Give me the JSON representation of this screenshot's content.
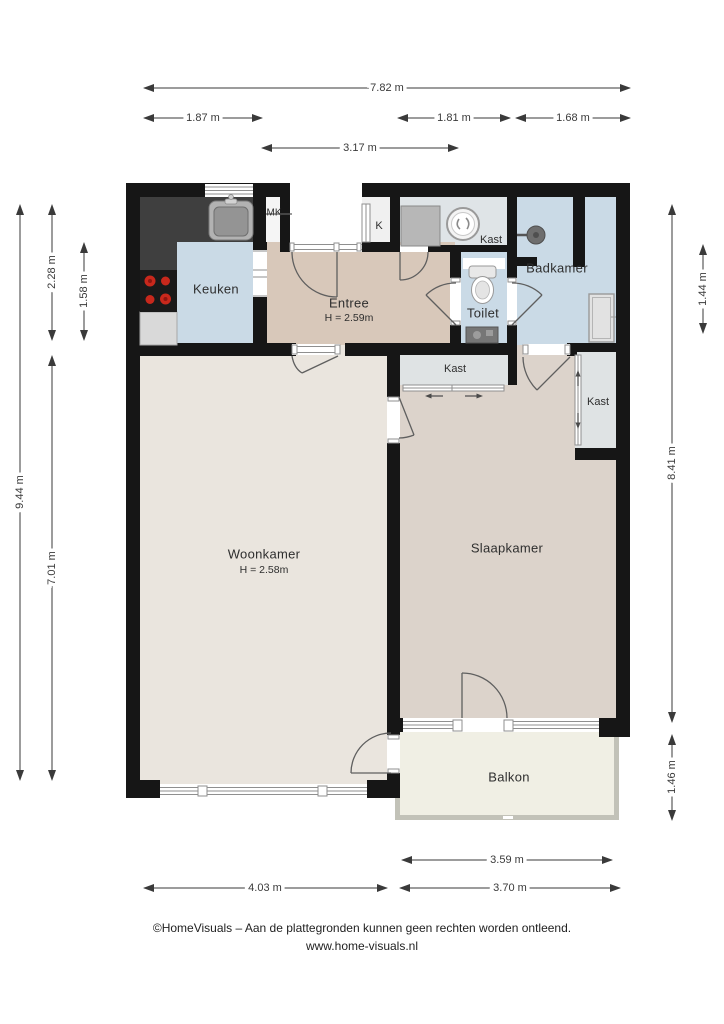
{
  "plan": {
    "rooms": {
      "keuken": {
        "label": "Keuken"
      },
      "entree": {
        "label": "Entree",
        "height_label": "H = 2.59m"
      },
      "mk": {
        "label": "MK"
      },
      "k": {
        "label": "K"
      },
      "kast_top": {
        "label": "Kast"
      },
      "toilet": {
        "label": "Toilet"
      },
      "badkamer": {
        "label": "Badkamer"
      },
      "kast_mid": {
        "label": "Kast"
      },
      "kast_right": {
        "label": "Kast"
      },
      "woonkamer": {
        "label": "Woonkamer",
        "height_label": "H = 2.58m"
      },
      "slaapkamer": {
        "label": "Slaapkamer"
      },
      "balkon": {
        "label": "Balkon"
      }
    },
    "dimensions": {
      "top_total": "7.82 m",
      "top_left": "1.87 m",
      "top_mid": "1.81 m",
      "top_right": "1.68 m",
      "top_entree": "3.17 m",
      "left_total": "9.44 m",
      "left_upper": "2.28 m",
      "left_kitchen": "1.58 m",
      "left_lower": "7.01 m",
      "right_upper": "1.44 m",
      "right_total": "8.41 m",
      "right_lower": "1.46 m",
      "bottom_balcony": "3.59 m",
      "bottom_left": "4.03 m",
      "bottom_right": "3.70 m"
    },
    "fixtures": [
      "kitchen-sink-icon",
      "stove-icon",
      "washing-machine-icon",
      "toilet-icon",
      "hand-basin-icon",
      "shower-head-icon",
      "radiator-icon",
      "sliding-door-arrow-icon"
    ],
    "colors": {
      "wall": "#161616",
      "wet_floor": "#cadae6",
      "entree_floor": "#d8c8ba",
      "living_floor": "#eae5de",
      "bedroom_floor": "#dcd3cb",
      "closet_floor": "#dfe3e4",
      "laundry_floor": "#dfe4e7",
      "balcony_floor": "#f0efe4",
      "counter": "#3f3f3f",
      "burner_red": "#c8281c",
      "dim": "#3a3a3a"
    }
  },
  "footer": {
    "line1": "©HomeVisuals – Aan de plattegronden kunnen geen rechten worden ontleend.",
    "line2": "www.home-visuals.nl"
  }
}
